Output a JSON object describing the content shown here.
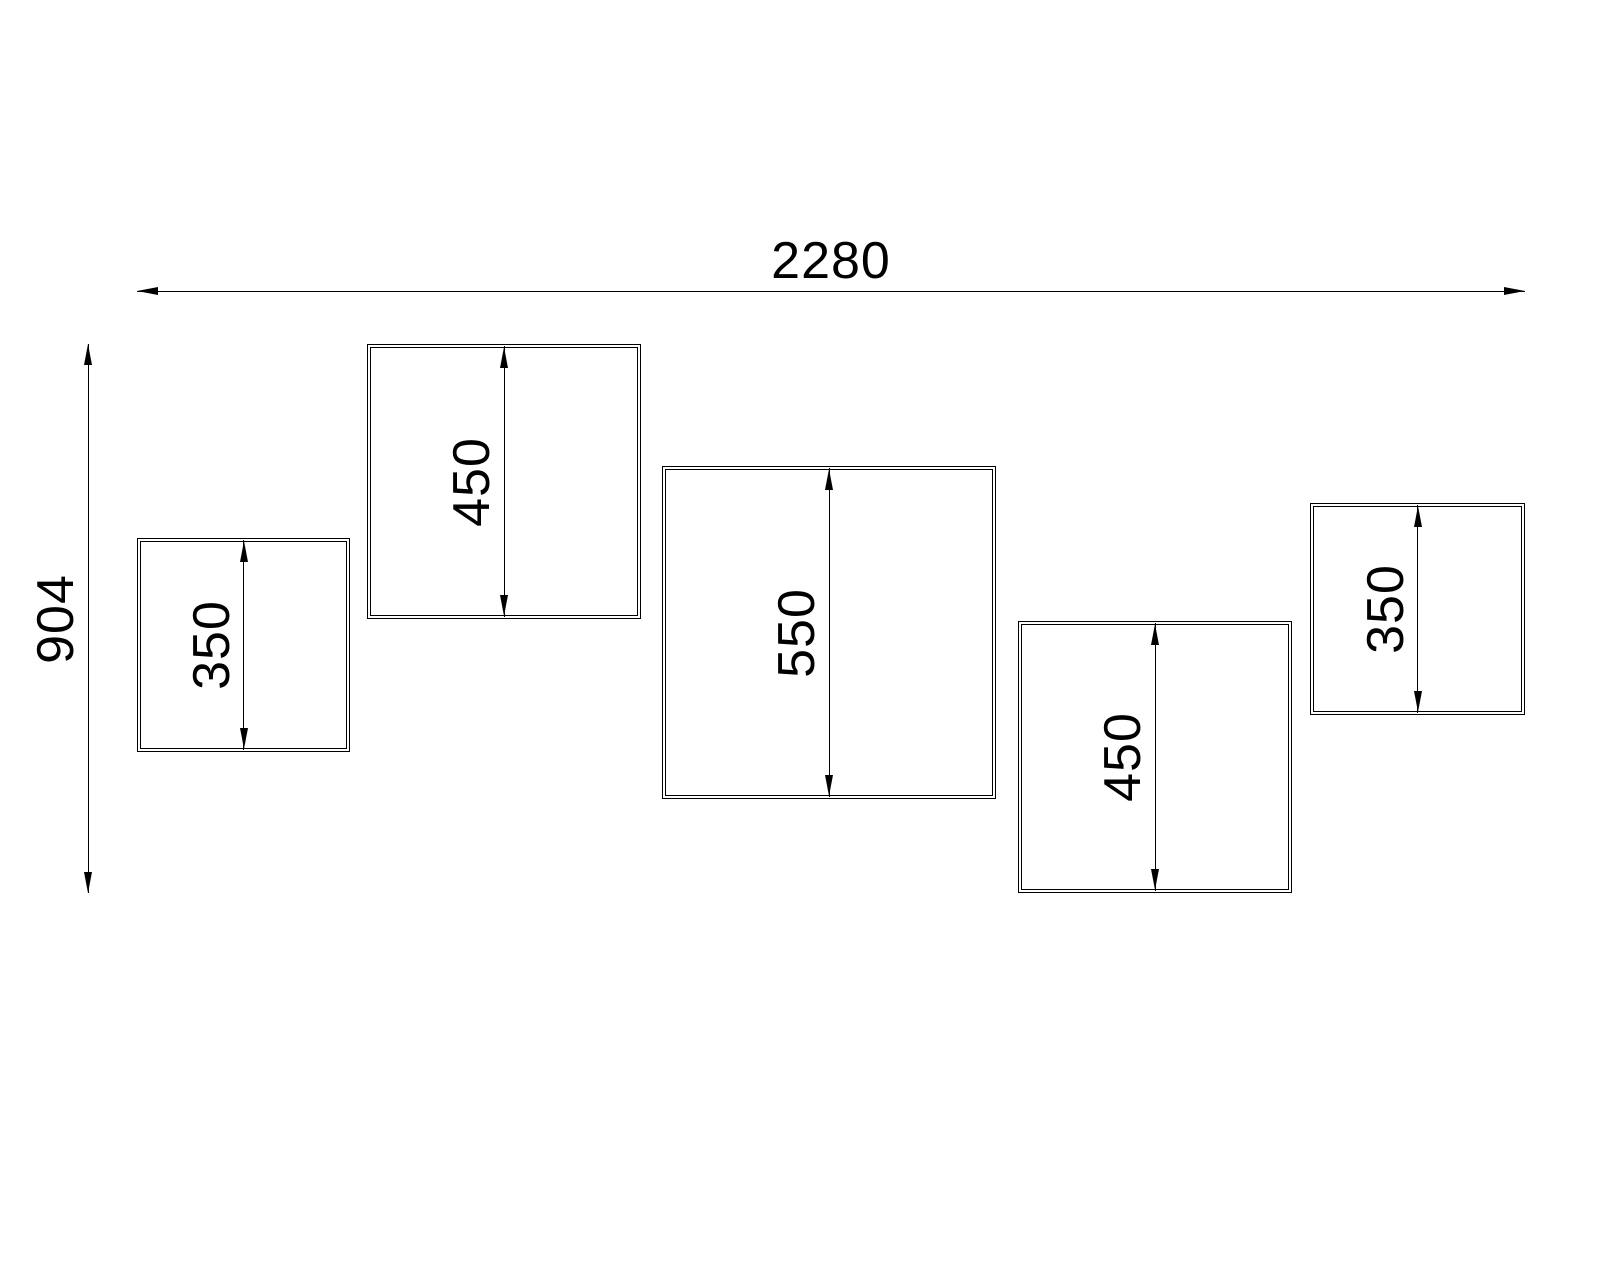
{
  "drawing": {
    "background_color": "#ffffff",
    "line_color": "#000000",
    "h_dim": {
      "label": "2280",
      "x": 137,
      "y": 291,
      "w": 1388,
      "h": 0
    },
    "v_dim": {
      "label": "904",
      "x": 88,
      "y": 344,
      "w": 0,
      "h": 549
    },
    "cubes": [
      {
        "label": "350",
        "x": 137,
        "y": 538,
        "w": 213,
        "h": 214
      },
      {
        "label": "450",
        "x": 367,
        "y": 344,
        "w": 274,
        "h": 275
      },
      {
        "label": "550",
        "x": 662,
        "y": 466,
        "w": 334,
        "h": 333
      },
      {
        "label": "450",
        "x": 1018,
        "y": 621,
        "w": 274,
        "h": 272
      },
      {
        "label": "350",
        "x": 1310,
        "y": 503,
        "w": 215,
        "h": 212
      }
    ]
  }
}
